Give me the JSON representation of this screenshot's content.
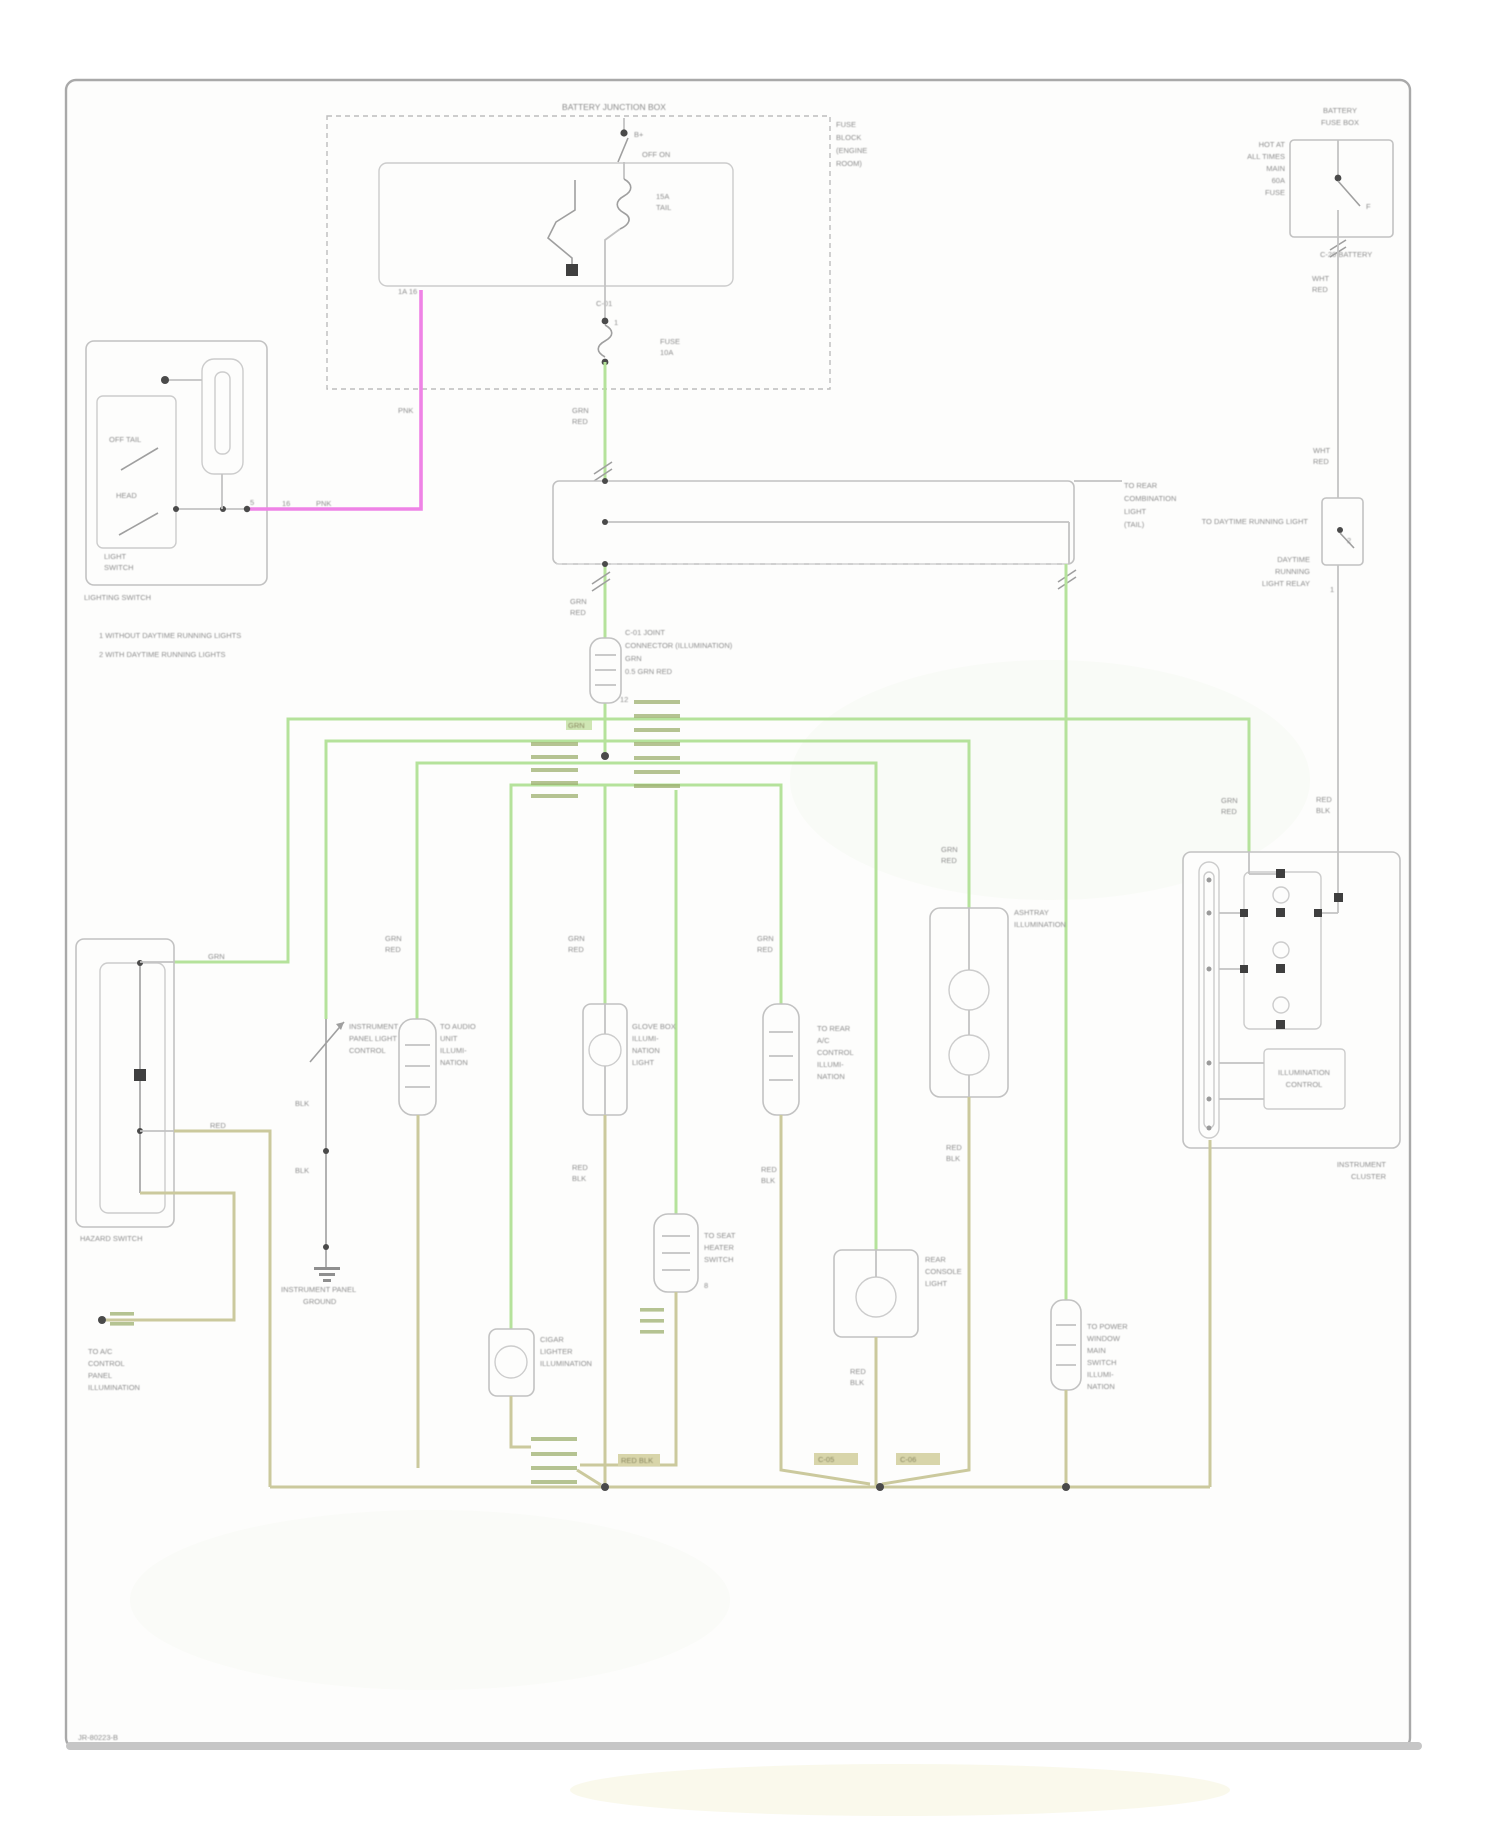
{
  "colors": {
    "wire_green": "#b5e29b",
    "wire_tan": "#cbc99d",
    "wire_magenta": "#ef83e6",
    "wire_gray": "#c3c3c3",
    "comb_connector": "#9db06f",
    "page_border": "#a9a9a9",
    "label_text": "#8f8f8f"
  },
  "page": {
    "footer": "JR-80223-B"
  },
  "fusebox": {
    "title": "BATTERY JUNCTION BOX",
    "side_l1": "FUSE",
    "side_l2": "BLOCK",
    "side_l3": "(ENGINE",
    "side_l4": "ROOM)",
    "sw_top": "B+",
    "sw_mid": "OFF  ON",
    "fuse1_l1": "15A",
    "fuse1_l2": "TAIL",
    "pin_c1": "C-01",
    "pin_n1": "1",
    "fuse2_l1": "FUSE",
    "fuse2_l2": "10A",
    "pin_mag": "1A  16"
  },
  "battery": {
    "t1": "BATTERY",
    "t2": "FUSE BOX",
    "s1": "HOT AT",
    "s2": "ALL TIMES",
    "s3": "MAIN",
    "s4": "60A",
    "s5": "FUSE",
    "sw": "F",
    "conn": "C-20 BATTERY",
    "w1": "WHT",
    "w2": "RED",
    "w3": "WHT",
    "w4": "RED",
    "drl_line": "TO DAYTIME RUNNING LIGHT",
    "drl_l1": "DAYTIME",
    "drl_l2": "RUNNING",
    "drl_l3": "LIGHT RELAY",
    "drl_p1": "2",
    "drl_p2": "1",
    "rw1": "RED",
    "rw2": "BLK"
  },
  "lighting_switch": {
    "name": "LIGHTING SWITCH",
    "pos1": "OFF  TAIL",
    "pos2": "HEAD",
    "b1": "LIGHT",
    "b2": "SWITCH",
    "pin": "5"
  },
  "notes": {
    "n1": "1   WITHOUT DAYTIME RUNNING LIGHTS",
    "n2": "2   WITH DAYTIME RUNNING LIGHTS"
  },
  "wires": {
    "mag_v": "PNK",
    "mag_h": "PNK",
    "mag_p": "16",
    "g1a": "GRN",
    "g1b": "RED",
    "g2a": "GRN",
    "g2b": "RED",
    "spl": "GRN"
  },
  "joint_connector": {
    "l1": "C-01 JOINT",
    "l2": "CONNECTOR (ILLUMINATION)",
    "l3": "GRN",
    "l4": "0.5 GRN RED",
    "p": "12"
  },
  "long_connector": {
    "t1": "TO REAR",
    "t2": "COMBINATION",
    "t3": "LIGHT",
    "t4": "(TAIL)"
  },
  "branches": {
    "hazard": {
      "name": "HAZARD SWITCH",
      "g": "GRN",
      "t": "RED"
    },
    "ac": {
      "l1": "TO A/C",
      "l2": "CONTROL",
      "l3": "PANEL",
      "l4": "ILLUMINATION"
    },
    "dimmer": {
      "l1": "INSTRUMENT",
      "l2": "PANEL LIGHT",
      "l3": "CONTROL",
      "w1": "BLK",
      "w2": "BLK",
      "g1": "INSTRUMENT PANEL",
      "g2": "GROUND"
    },
    "c2": {
      "l1": "TO AUDIO",
      "l2": "UNIT",
      "l3": "ILLUMI-",
      "l4": "NATION",
      "w1": "GRN",
      "w2": "RED"
    },
    "c3": {
      "l1": "GLOVE BOX",
      "l2": "ILLUMI-",
      "l3": "NATION",
      "l4": "LIGHT",
      "w1": "GRN",
      "w2": "RED",
      "t1": "RED",
      "t2": "BLK"
    },
    "c4": {
      "l1": "TO REAR",
      "l2": "A/C",
      "l3": "CONTROL",
      "l4": "ILLUMI-",
      "l5": "NATION",
      "w1": "GRN",
      "w2": "RED",
      "t1": "RED",
      "t2": "BLK"
    },
    "c5": {
      "l1": "ASHTRAY",
      "l2": "ILLUMINATION",
      "w1": "GRN",
      "w2": "RED",
      "t1": "RED",
      "t2": "BLK"
    },
    "b0": {
      "l1": "CIGAR",
      "l2": "LIGHTER",
      "l3": "ILLUMINATION"
    },
    "lo2": {
      "l1": "TO SEAT",
      "l2": "HEATER",
      "l3": "SWITCH",
      "p": "8"
    },
    "lo3": {
      "l1": "REAR",
      "l2": "CONSOLE",
      "l3": "LIGHT",
      "t1": "RED",
      "t2": "BLK"
    },
    "d": {
      "l1": "TO POWER",
      "l2": "WINDOW",
      "l3": "MAIN",
      "l4": "SWITCH",
      "l5": "ILLUMI-",
      "l6": "NATION"
    }
  },
  "cluster": {
    "w1": "GRN",
    "w2": "RED",
    "sub1": "ILLUMINATION",
    "sub2": "CONTROL",
    "l1": "INSTRUMENT",
    "l2": "CLUSTER"
  },
  "bus": {
    "chip": "RED BLK",
    "c1": "C-05",
    "c2": "C-06"
  }
}
